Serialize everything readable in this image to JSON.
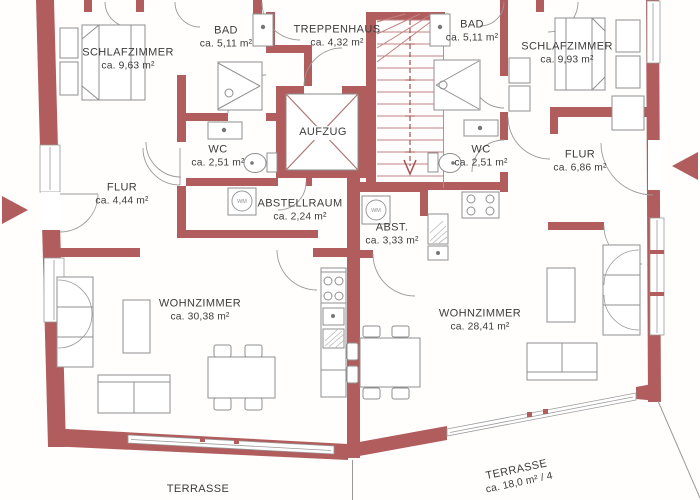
{
  "plan": {
    "type": "apartment-floor-plan",
    "language": "de",
    "wall_color": "#b25d5d",
    "background": "#fffefd",
    "text_color": "#3c3c3c"
  },
  "rooms": [
    {
      "id": "schlafzimmer-left",
      "name": "SCHLAFZIMMER",
      "area": "ca. 9,63 m²"
    },
    {
      "id": "bad-left",
      "name": "BAD",
      "area": "ca. 5,11 m²"
    },
    {
      "id": "treppenhaus",
      "name": "TREPPENHAUS",
      "area": "ca. 4,32 m²"
    },
    {
      "id": "bad-right",
      "name": "BAD",
      "area": "ca. 5,11 m²"
    },
    {
      "id": "schlafzimmer-right",
      "name": "SCHLAFZIMMER",
      "area": "ca. 9,93 m²"
    },
    {
      "id": "wc-left",
      "name": "WC",
      "area": "ca. 2,51 m²"
    },
    {
      "id": "aufzug",
      "name": "AUFZUG",
      "area": ""
    },
    {
      "id": "wc-right",
      "name": "WC",
      "area": "ca. 2,51 m²"
    },
    {
      "id": "flur-left",
      "name": "FLUR",
      "area": "ca. 4,44 m²"
    },
    {
      "id": "flur-right",
      "name": "FLUR",
      "area": "ca. 6,86 m²"
    },
    {
      "id": "abstellraum",
      "name": "ABSTELLRAUM",
      "area": "ca. 2,24 m²"
    },
    {
      "id": "abst",
      "name": "ABST.",
      "area": "ca. 3,33 m²"
    },
    {
      "id": "wohnzimmer-left",
      "name": "WOHNZIMMER",
      "area": "ca. 30,38 m²"
    },
    {
      "id": "wohnzimmer-right",
      "name": "WOHNZIMMER",
      "area": "ca. 28,41 m²"
    },
    {
      "id": "terrasse-left",
      "name": "TERRASSE",
      "area": ""
    },
    {
      "id": "terrasse-right",
      "name": "TERRASSE",
      "area": "ca. 18,0 m² / 4"
    }
  ],
  "fixtures": {
    "wm_label": "WM"
  },
  "icons": {
    "entrance_left": "arrow-right-icon",
    "entrance_right": "arrow-left-icon"
  }
}
